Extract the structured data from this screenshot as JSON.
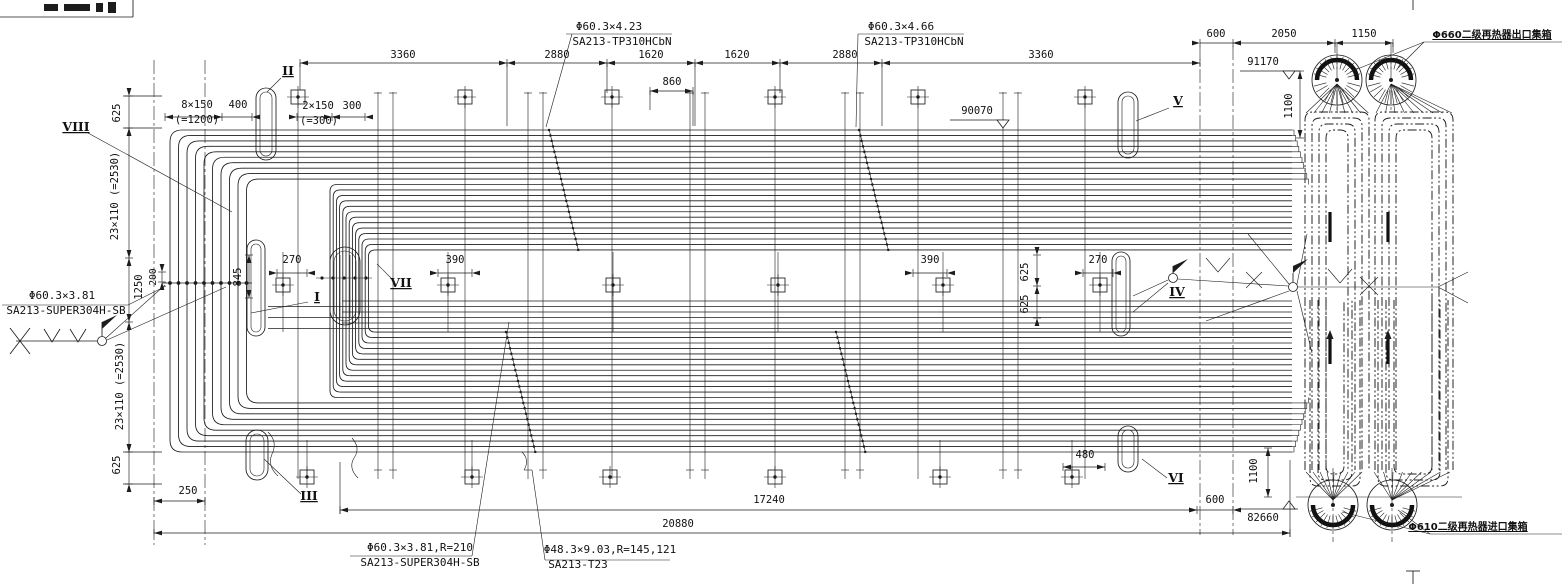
{
  "drawing": {
    "type": "boiler secondary reheater tube-bank arrangement, side elevation",
    "ink_color": "#1c1c1c",
    "background": "#ffffff"
  },
  "annotations": {
    "dimensions": [
      {
        "name": "dim-3360-a",
        "t": "3360",
        "x": 403,
        "y": 58
      },
      {
        "name": "dim-2880-a",
        "t": "2880",
        "x": 557,
        "y": 58
      },
      {
        "name": "dim-1620-a",
        "t": "1620",
        "x": 651,
        "y": 58
      },
      {
        "name": "dim-1620-b",
        "t": "1620",
        "x": 737,
        "y": 58
      },
      {
        "name": "dim-2880-b",
        "t": "2880",
        "x": 845,
        "y": 58
      },
      {
        "name": "dim-3360-b",
        "t": "3360",
        "x": 1041,
        "y": 58
      },
      {
        "name": "dim-860",
        "t": "860",
        "x": 672,
        "y": 85
      },
      {
        "name": "dim-600-top",
        "t": "600",
        "x": 1216,
        "y": 37
      },
      {
        "name": "dim-2050",
        "t": "2050",
        "x": 1284,
        "y": 37
      },
      {
        "name": "dim-1150",
        "t": "1150",
        "x": 1364,
        "y": 37
      },
      {
        "name": "dim-1100-top",
        "t": "1100",
        "x": 1292,
        "y": 106,
        "r": 1
      },
      {
        "name": "dim-8x150",
        "t": "8×150",
        "x": 197,
        "y": 108
      },
      {
        "name": "dim-400",
        "t": "400",
        "x": 238,
        "y": 108
      },
      {
        "name": "dim-eq1200",
        "t": "(=1200)",
        "x": 197,
        "y": 123
      },
      {
        "name": "dim-2x150",
        "t": "2×150",
        "x": 318,
        "y": 109
      },
      {
        "name": "dim-300",
        "t": "300",
        "x": 352,
        "y": 109
      },
      {
        "name": "dim-eq300",
        "t": "(=300)",
        "x": 319,
        "y": 124
      },
      {
        "name": "dim-625-top-left",
        "t": "625",
        "x": 120,
        "y": 113,
        "r": 1
      },
      {
        "name": "dim-23x110-upper",
        "t": "23×110 (=2530)",
        "x": 118,
        "y": 196,
        "r": 1
      },
      {
        "name": "dim-1250",
        "t": "1250",
        "x": 142,
        "y": 287,
        "r": 1
      },
      {
        "name": "dim-200",
        "t": "200",
        "x": 156,
        "y": 277,
        "r": 1,
        "cls": "sm"
      },
      {
        "name": "dim-845",
        "t": "845",
        "x": 241,
        "y": 277,
        "r": 1
      },
      {
        "name": "dim-270-left",
        "t": "270",
        "x": 292,
        "y": 263
      },
      {
        "name": "dim-390-left",
        "t": "390",
        "x": 455,
        "y": 263
      },
      {
        "name": "dim-390-right",
        "t": "390",
        "x": 930,
        "y": 263
      },
      {
        "name": "dim-625-mid-1",
        "t": "625",
        "x": 1028,
        "y": 272,
        "r": 1
      },
      {
        "name": "dim-625-mid-2",
        "t": "625",
        "x": 1028,
        "y": 304,
        "r": 1
      },
      {
        "name": "dim-270-right",
        "t": "270",
        "x": 1098,
        "y": 263
      },
      {
        "name": "dim-480",
        "t": "480",
        "x": 1085,
        "y": 458
      },
      {
        "name": "dim-23x110-lower",
        "t": "23×110 (=2530)",
        "x": 123,
        "y": 386,
        "r": 1
      },
      {
        "name": "dim-625-bottom-left",
        "t": "625",
        "x": 120,
        "y": 465,
        "r": 1
      },
      {
        "name": "dim-250",
        "t": "250",
        "x": 188,
        "y": 494
      },
      {
        "name": "dim-17240",
        "t": "17240",
        "x": 769,
        "y": 503
      },
      {
        "name": "dim-600-bottom",
        "t": "600",
        "x": 1215,
        "y": 503
      },
      {
        "name": "dim-20880",
        "t": "20880",
        "x": 678,
        "y": 527
      },
      {
        "name": "dim-1100-bottom",
        "t": "1100",
        "x": 1257,
        "y": 471,
        "r": 1
      }
    ],
    "levels": [
      {
        "name": "level-91170",
        "t": "91170",
        "x": 1263,
        "y": 65
      },
      {
        "name": "level-90070",
        "t": "90070",
        "x": 977,
        "y": 114
      },
      {
        "name": "level-82660",
        "t": "82660",
        "x": 1263,
        "y": 521
      }
    ],
    "materials": [
      {
        "name": "material-callout-1-spec",
        "t": "Φ60.3×4.23",
        "x": 609,
        "y": 30,
        "cls": "mat"
      },
      {
        "name": "material-callout-1-grade",
        "t": "SA213-TP310HCbN",
        "x": 622,
        "y": 45,
        "cls": "mat"
      },
      {
        "name": "material-callout-2-spec",
        "t": "Φ60.3×4.66",
        "x": 901,
        "y": 30,
        "cls": "mat"
      },
      {
        "name": "material-callout-2-grade",
        "t": "SA213-TP310HCbN",
        "x": 914,
        "y": 45,
        "cls": "mat"
      },
      {
        "name": "material-callout-left-spec",
        "t": "Φ60.3×3.81",
        "x": 62,
        "y": 299,
        "cls": "mat"
      },
      {
        "name": "material-callout-left-grade",
        "t": "SA213-SUPER304H-SB",
        "x": 66,
        "y": 314,
        "cls": "mat"
      },
      {
        "name": "material-callout-bottom-1-spec",
        "t": "Φ60.3×3.81,R=210",
        "x": 420,
        "y": 551,
        "cls": "mat"
      },
      {
        "name": "material-callout-bottom-1-grade",
        "t": "SA213-SUPER304H-SB",
        "x": 420,
        "y": 566,
        "cls": "mat"
      },
      {
        "name": "material-callout-bottom-2-spec",
        "t": "Φ48.3×9.03,R=145,121",
        "x": 610,
        "y": 553,
        "cls": "mat"
      },
      {
        "name": "material-callout-bottom-2-grade",
        "t": "SA213-T23",
        "x": 578,
        "y": 568,
        "cls": "mat"
      }
    ],
    "headers": [
      {
        "name": "label-outlet-header",
        "t": "Φ660二级再热器出口集箱",
        "x": 1492,
        "y": 38,
        "cls": "hdr"
      },
      {
        "name": "label-inlet-header",
        "t": "Φ610二级再热器进口集箱",
        "x": 1468,
        "y": 530,
        "cls": "hdr"
      }
    ],
    "section_marks": [
      {
        "name": "section-mark-viii",
        "t": "VIII",
        "x": 76,
        "y": 131,
        "cls": "mark"
      },
      {
        "name": "section-mark-ii",
        "t": "II",
        "x": 288,
        "y": 75,
        "cls": "mark"
      },
      {
        "name": "section-mark-vii",
        "t": "VII",
        "x": 401,
        "y": 287,
        "cls": "mark"
      },
      {
        "name": "section-mark-i",
        "t": "I",
        "x": 317,
        "y": 301,
        "cls": "mark"
      },
      {
        "name": "section-mark-iii",
        "t": "III",
        "x": 309,
        "y": 500,
        "cls": "mark"
      },
      {
        "name": "section-mark-iv",
        "t": "IV",
        "x": 1177,
        "y": 296,
        "cls": "mark"
      },
      {
        "name": "section-mark-v",
        "t": "V",
        "x": 1178,
        "y": 105,
        "cls": "mark"
      },
      {
        "name": "section-mark-vi",
        "t": "VI",
        "x": 1176,
        "y": 482,
        "cls": "mark"
      }
    ]
  }
}
